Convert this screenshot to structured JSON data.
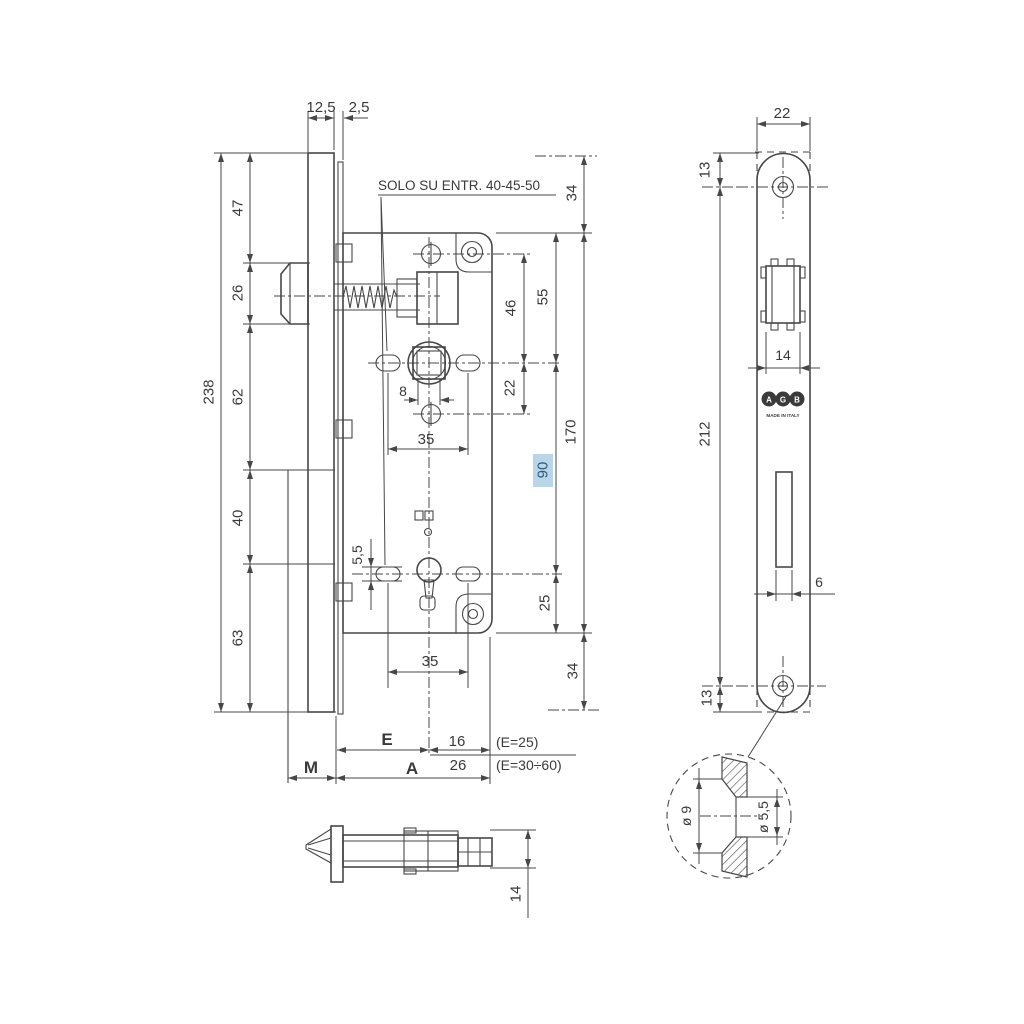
{
  "note": {
    "text": "SOLO SU ENTR. 40-45-50"
  },
  "colors": {
    "line": "#474747",
    "text": "#3a3a3a",
    "highlight_bg": "#b9d6e9",
    "highlight_text": "#2f5a7a"
  },
  "front_view_dims": {
    "offset_12_5": "12,5",
    "thickness_2_5": "2,5",
    "seg_47": "47",
    "seg_26": "26",
    "seg_62": "62",
    "seg_40": "40",
    "seg_63": "63",
    "total_238": "238",
    "top_34": "34",
    "d_55": "55",
    "d_46": "46",
    "d_22": "22",
    "d_170": "170",
    "d_90": "90",
    "d_25": "25",
    "bottom_34": "34",
    "square_8": "8",
    "spacing_35_top": "35",
    "spacing_35_bottom": "35",
    "slot_5_5": "5,5"
  },
  "backset_dims": {
    "e": "E",
    "v16": "16",
    "e25": "(E=25)",
    "v26": "26",
    "e3060": "(E=30÷60)",
    "m": "M",
    "a": "A"
  },
  "latch_view": {
    "d14": "14"
  },
  "faceplate_view": {
    "w22": "22",
    "t13": "13",
    "latch_14": "14",
    "h212": "212",
    "slot_6": "6",
    "b13": "13",
    "logo": [
      "A",
      "G",
      "B"
    ],
    "made_in": "MADE IN ITALY"
  },
  "detail_view": {
    "d9": "ø 9",
    "d55": "ø 5,5"
  }
}
